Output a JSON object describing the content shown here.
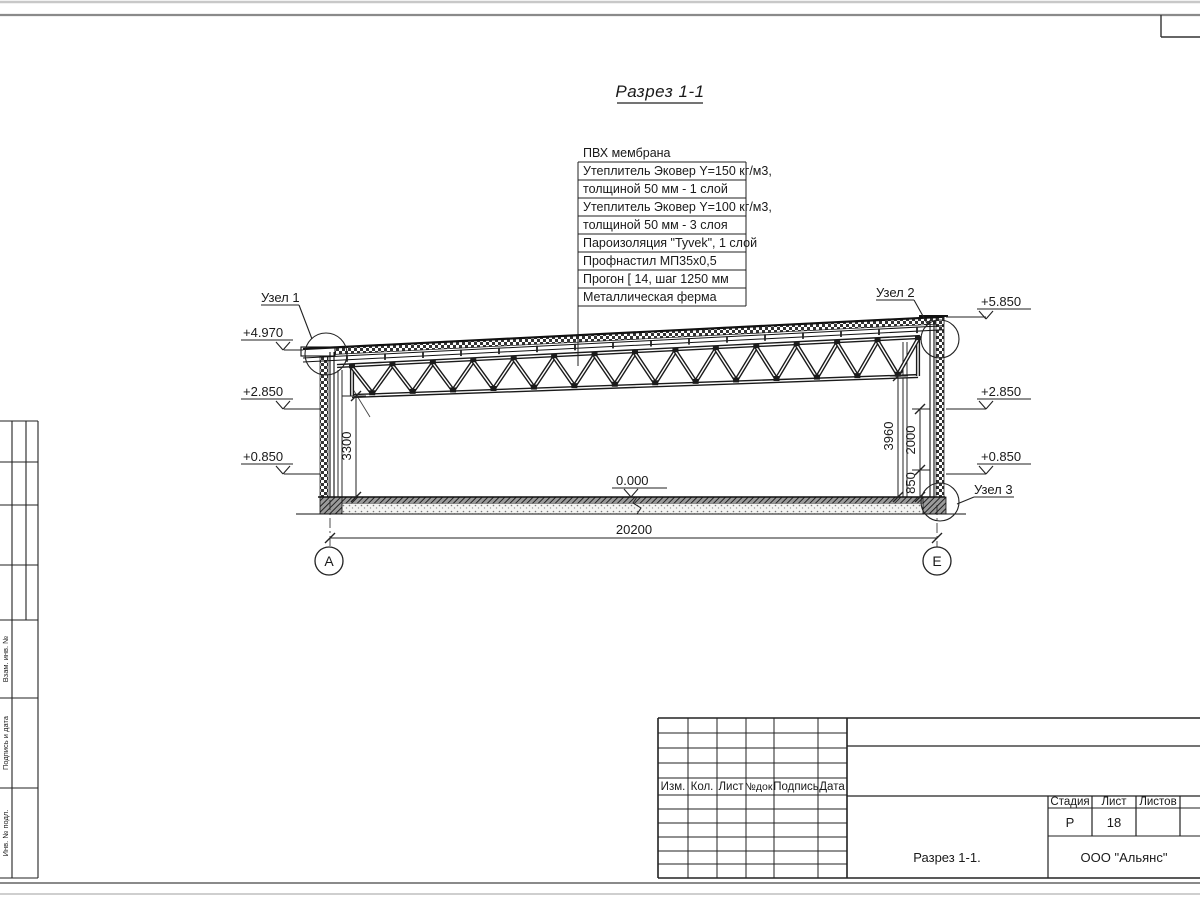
{
  "drawing": {
    "title": "Разрез 1-1",
    "callouts": [
      "ПВХ мембрана",
      "Утеплитель Эковер Y=150 кг/м3,",
      "толщиной 50 мм - 1 слой",
      "Утеплитель Эковер Y=100 кг/м3,",
      "толщиной 50 мм - 3 слоя",
      "Пароизоляция \"Tyvek\", 1 слой",
      "Профнастил МП35х0,5",
      "Прогон [ 14, шаг 1250 мм",
      "Металлическая ферма"
    ],
    "nodes": {
      "node1": "Узел 1",
      "node2": "Узел 2",
      "node3": "Узел 3"
    },
    "elevations": {
      "left_top": "+4.970",
      "left_mid": "+2.850",
      "left_low": "+0.850",
      "right_top": "+5.850",
      "right_mid": "+2.850",
      "right_low": "+0.850",
      "floor": "0.000"
    },
    "dimensions": {
      "span": "20200",
      "left_height": "3300",
      "right_height": "3960",
      "opening": "2000",
      "sill": "850"
    },
    "grid_axes": {
      "left": "А",
      "right": "Е"
    }
  },
  "title_block": {
    "revision_columns": [
      "Изм.",
      "Кол.",
      "Лист",
      "№док.",
      "Подпись",
      "Дата"
    ],
    "stage_label": "Стадия",
    "sheet_label": "Лист",
    "sheets_label": "Листов",
    "stage_value": "Р",
    "sheet_value": "18",
    "sheets_value": "",
    "drawing_name": "Разрез 1-1.",
    "company": "ООО \"Альянс\""
  },
  "side_strip": {
    "labels": [
      "Взам. инв. №",
      "Подпись и дата",
      "Инв. № подл."
    ]
  }
}
